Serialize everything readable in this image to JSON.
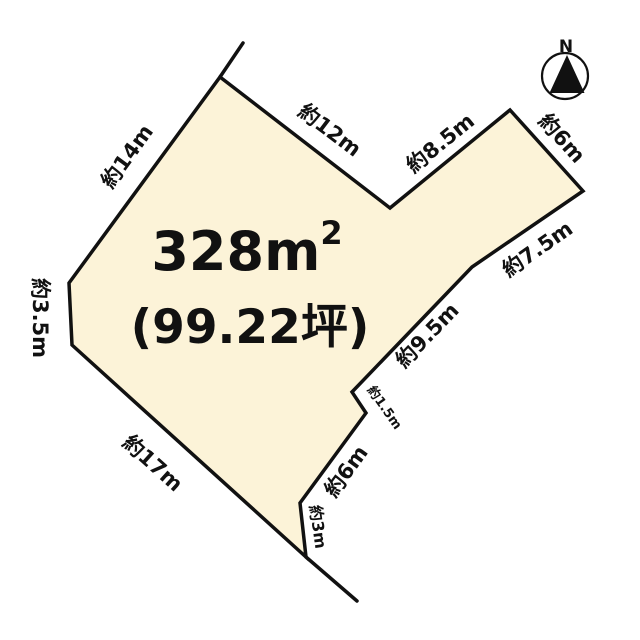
{
  "diagram_type": "land-parcel-plan",
  "parcel": {
    "area_m2_main": "328m",
    "area_m2_sup": "2",
    "area_tsubo": "(99.22坪)",
    "fill_color": "#FCF3D8",
    "line_color": "#111111"
  },
  "compass": {
    "north_label": "N"
  },
  "edge_labels": [
    {
      "side": "northwest",
      "text": "約14m"
    },
    {
      "side": "north-notch-left",
      "text": "約12m"
    },
    {
      "side": "north-notch-right",
      "text": "約8.5m"
    },
    {
      "side": "northeast",
      "text": "約6m"
    },
    {
      "side": "east-upper",
      "text": "約7.5m"
    },
    {
      "side": "east-middle",
      "text": "約9.5m"
    },
    {
      "side": "east-step",
      "text": "約1.5m"
    },
    {
      "side": "southeast-upper",
      "text": "約6m"
    },
    {
      "side": "southeast-lower",
      "text": "約3m"
    },
    {
      "side": "southwest",
      "text": "約17m"
    },
    {
      "side": "west",
      "text": "約3.5m"
    }
  ]
}
